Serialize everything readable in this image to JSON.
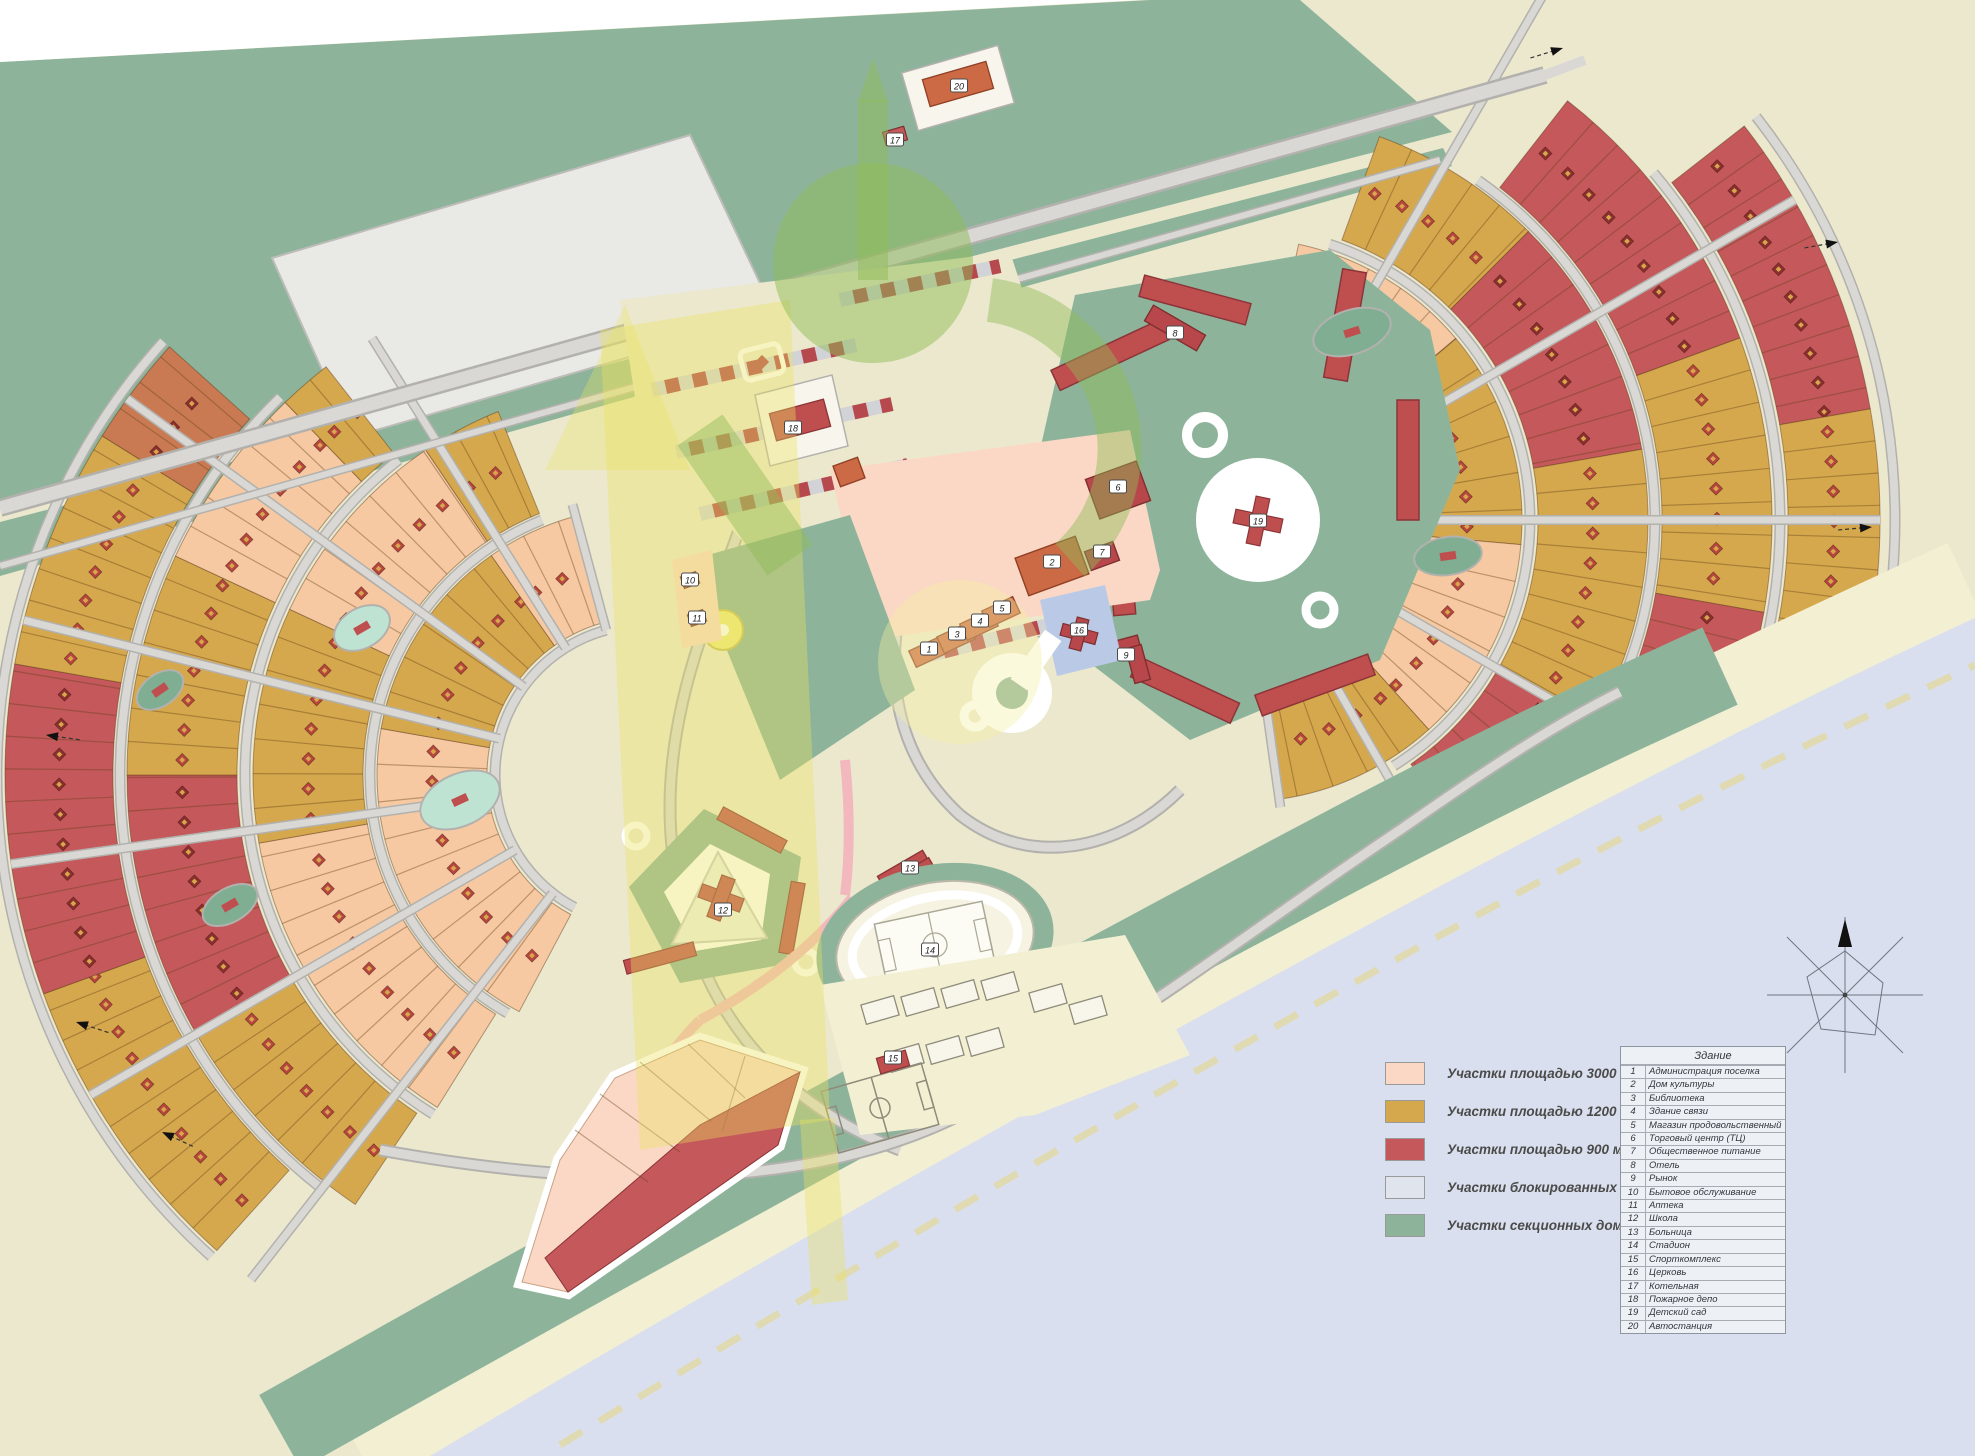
{
  "title": "Генеральный план поселка",
  "colors": {
    "land": "#ece8cd",
    "green_zone": "#8db49a",
    "green_dark": "#7fae93",
    "water": "#d9dfee",
    "beach": "#f3efd3",
    "sand_dash": "#e0dab2",
    "road": "#d9d8d4",
    "road_casing": "#b2b1ad",
    "lot_pink": "#fbd8c5",
    "lot_peach": "#f6c9a2",
    "lot_gold": "#d6a84d",
    "lot_red": "#c4585a",
    "lot_terracotta": "#c97a52",
    "blocked_gray": "#d2d3d6",
    "blocked_red": "#b5494d",
    "building_red": "#bf4f4f",
    "building_orange": "#cc6a45",
    "marker_dark": "#8c2f2f",
    "marker_gold": "#d7a74c",
    "pink_path": "#f2b8bd",
    "church_blue": "#b9c9e6",
    "pond": "#bfe3d2",
    "industrial_gray": "#e9e9e6",
    "wm_yellow": "#e9e35f",
    "wm_green": "#8fbb57"
  },
  "legend": {
    "items": [
      {
        "color": "#fbd8c5",
        "label": "Участки площадью 3000 м.кв."
      },
      {
        "color": "#d6a84d",
        "label": "Участки площадью 1200 м.кв."
      },
      {
        "color": "#c4585a",
        "label": "Участки площадью 900 м.кв."
      },
      {
        "color": "#e0e4ec",
        "label": "Участки блокированных домов"
      },
      {
        "color": "#8db49a",
        "label": "Участки секционных домов"
      }
    ]
  },
  "buildings_table": {
    "header": "Здание",
    "rows": [
      {
        "num": "1",
        "name": "Администрация поселка"
      },
      {
        "num": "2",
        "name": "Дом культуры"
      },
      {
        "num": "3",
        "name": "Библиотека"
      },
      {
        "num": "4",
        "name": "Здание связи"
      },
      {
        "num": "5",
        "name": "Магазин продовольственный"
      },
      {
        "num": "6",
        "name": "Торговый центр (ТЦ)"
      },
      {
        "num": "7",
        "name": "Общественное питание"
      },
      {
        "num": "8",
        "name": "Отель"
      },
      {
        "num": "9",
        "name": "Рынок"
      },
      {
        "num": "10",
        "name": "Бытовое обслуживание"
      },
      {
        "num": "11",
        "name": "Аптека"
      },
      {
        "num": "12",
        "name": "Школа"
      },
      {
        "num": "13",
        "name": "Больница"
      },
      {
        "num": "14",
        "name": "Стадион"
      },
      {
        "num": "15",
        "name": "Спорткомплекс"
      },
      {
        "num": "16",
        "name": "Церковь"
      },
      {
        "num": "17",
        "name": "Котельная"
      },
      {
        "num": "18",
        "name": "Пожарное депо"
      },
      {
        "num": "19",
        "name": "Детский сад"
      },
      {
        "num": "20",
        "name": "Автостанция"
      }
    ]
  },
  "map": {
    "markers": [
      {
        "n": "1",
        "x": 929,
        "y": 649
      },
      {
        "n": "2",
        "x": 1052,
        "y": 562
      },
      {
        "n": "3",
        "x": 957,
        "y": 634
      },
      {
        "n": "4",
        "x": 980,
        "y": 621
      },
      {
        "n": "5",
        "x": 1002,
        "y": 608
      },
      {
        "n": "6",
        "x": 1118,
        "y": 487
      },
      {
        "n": "7",
        "x": 1102,
        "y": 552
      },
      {
        "n": "8",
        "x": 1175,
        "y": 333
      },
      {
        "n": "9",
        "x": 1126,
        "y": 655
      },
      {
        "n": "10",
        "x": 690,
        "y": 580
      },
      {
        "n": "11",
        "x": 697,
        "y": 618
      },
      {
        "n": "12",
        "x": 723,
        "y": 910
      },
      {
        "n": "13",
        "x": 910,
        "y": 868
      },
      {
        "n": "14",
        "x": 930,
        "y": 950
      },
      {
        "n": "15",
        "x": 893,
        "y": 1058
      },
      {
        "n": "16",
        "x": 1079,
        "y": 630
      },
      {
        "n": "17",
        "x": 895,
        "y": 140
      },
      {
        "n": "18",
        "x": 793,
        "y": 428
      },
      {
        "n": "19",
        "x": 1258,
        "y": 521
      },
      {
        "n": "20",
        "x": 959,
        "y": 86
      }
    ]
  }
}
